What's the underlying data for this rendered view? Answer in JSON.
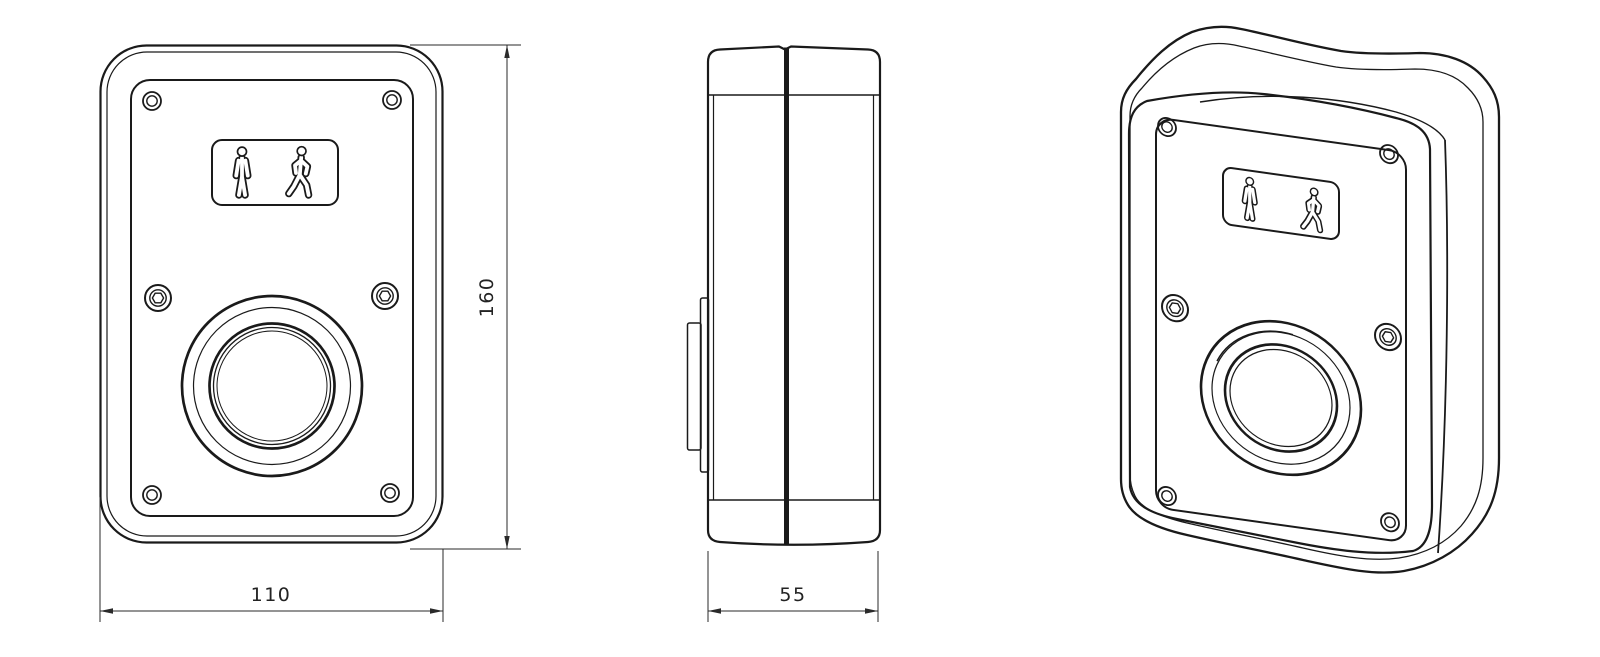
{
  "drawing": {
    "background": "#ffffff",
    "line_color": "#1a1a1a",
    "dimension_color": "#2a2a2a",
    "views": {
      "front": {
        "width_label": "110",
        "height_label": "160"
      },
      "side": {
        "depth_label": "55"
      }
    },
    "icons": {
      "standing_person": "standing-person-icon",
      "walking_person": "walking-person-icon"
    }
  }
}
